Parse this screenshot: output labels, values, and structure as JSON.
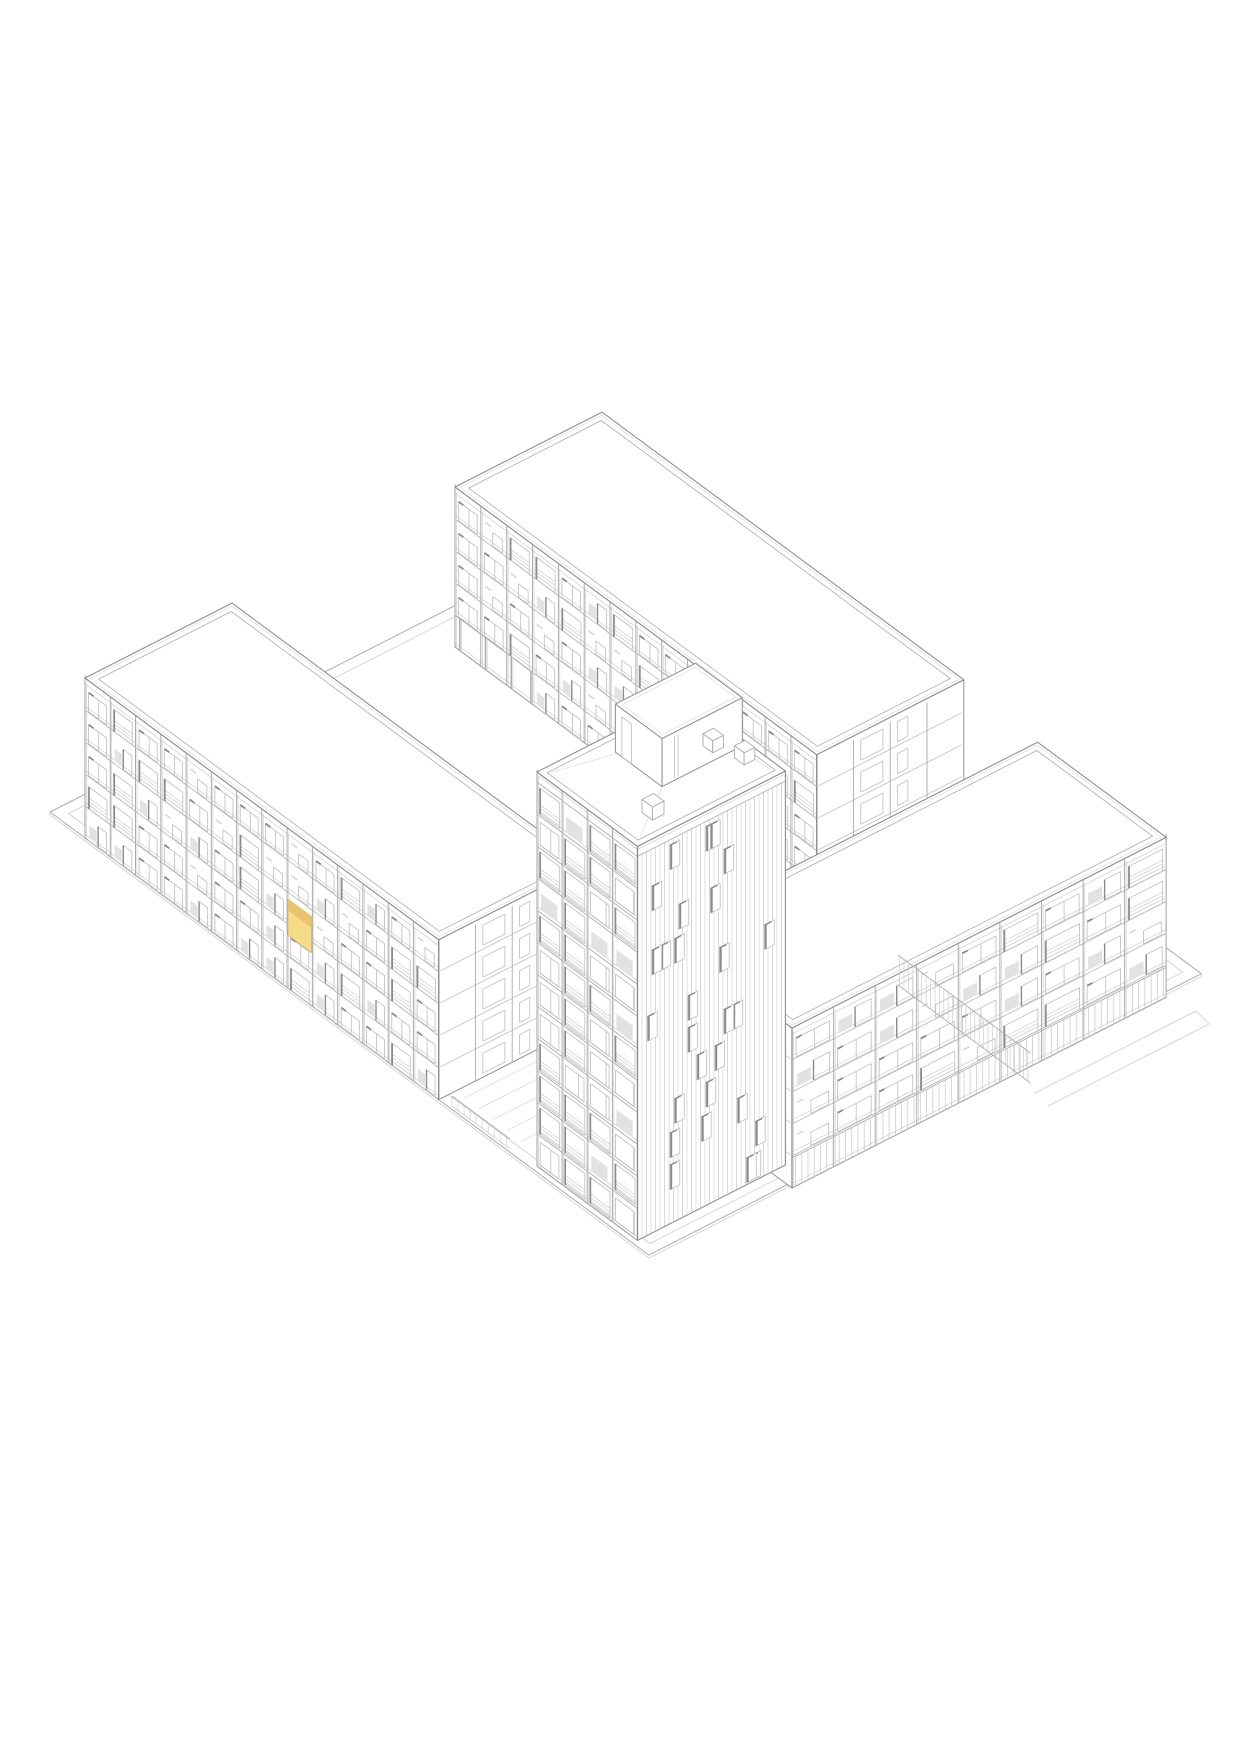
{
  "page": {
    "background": "#ffffff"
  },
  "drawing": {
    "canvas": {
      "width": 1241,
      "height": 1754
    },
    "projection": {
      "a_deg": 36.5,
      "b_deg": 27
    },
    "story_height": 32,
    "colors": {
      "bg": "#ffffff",
      "white": "#ffffff",
      "outline": "#8f8f8f",
      "dark": "#8a8a8a",
      "line": "#acacac",
      "grid": "#bdbdbd",
      "light": "#cdcdcd",
      "faint": "#dcdcdc",
      "panel": "#e2e2e2",
      "highlight_fill": "#f6dc89",
      "highlight_band": "#e9c46c",
      "highlight_edge": "#d8b254"
    },
    "site": {
      "origin": [
        50,
        812
      ],
      "len_a": 745,
      "len_b": 620,
      "inset": 11
    },
    "buildings": [
      {
        "id": "north-wing",
        "axis": "A",
        "anchor_top": [
          455,
          487
        ],
        "length": 450,
        "depth": 165,
        "stories": 5,
        "bays": 14,
        "seed": 31,
        "pilotis_bays": 3
      },
      {
        "id": "east-wing",
        "axis": "B",
        "anchor_top": [
          792,
          1028
        ],
        "length": 420,
        "depth": 160,
        "stories": 5,
        "bays": 9,
        "seed": 52,
        "colonnade": true
      },
      {
        "id": "west-wing",
        "axis": "A",
        "anchor_top": [
          85,
          678
        ],
        "length": 440,
        "depth": 165,
        "stories": 5,
        "bays": 14,
        "seed": 7,
        "highlight": {
          "floor_from_top": 2,
          "bay": 8
        }
      },
      {
        "id": "tower",
        "type": "tower",
        "anchor_top": [
          537,
          772
        ],
        "width_a": 125,
        "width_b": 166,
        "stories": 12,
        "parapet": 10,
        "seed": 19,
        "bulkhead": {
          "a0": 20,
          "a1": 78,
          "b0": 70,
          "b1": 160,
          "h": 48
        },
        "vents": [
          {
            "a": 100,
            "b": 40,
            "s": 13,
            "h": 13
          },
          {
            "a": 64,
            "b": 140,
            "s": 12,
            "h": 12
          },
          {
            "a": 92,
            "b": 150,
            "s": 12,
            "h": 12
          }
        ]
      }
    ],
    "ground": {
      "paving_front": {
        "a0": 495,
        "b0": 18,
        "da": 18,
        "n": 5,
        "len": 150
      },
      "paving_back": {
        "a0": 600,
        "b0": 250,
        "db": 55,
        "n": 3,
        "len": 145
      },
      "fence": {
        "origin": [
          898,
          985
        ],
        "len": 165,
        "height": 30,
        "post_step": 5.5
      },
      "railing": {
        "origin": [
          452,
          1106
        ],
        "len": 72,
        "height": 10,
        "post_step": 7.5
      },
      "ramp": [
        [
          [
            1035,
            1093
          ],
          [
            1196,
            1011
          ]
        ],
        [
          [
            1048,
            1106
          ],
          [
            1209,
            1024
          ]
        ],
        [
          [
            1196,
            1011
          ],
          [
            1209,
            1024
          ]
        ]
      ]
    },
    "highlighted_unit": {
      "building": "west-wing",
      "floor_from_top": 2,
      "bay": 8,
      "fill": "#f6dc89"
    }
  }
}
